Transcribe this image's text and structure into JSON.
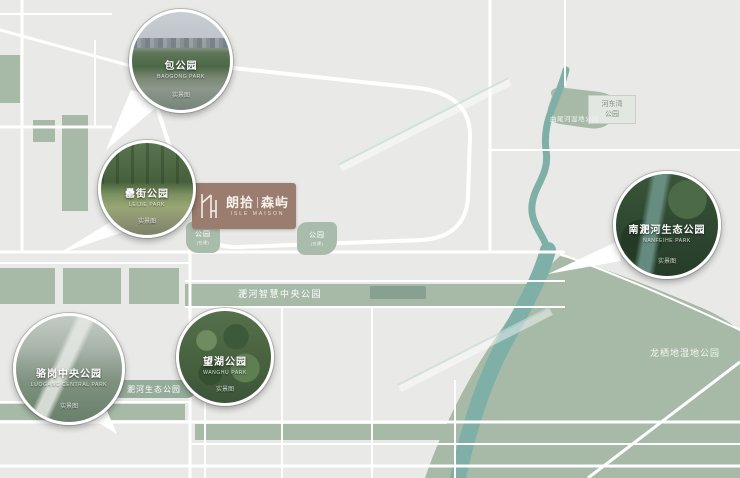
{
  "brand": {
    "cn_left": "朗拾",
    "cn_right": "森屿",
    "en": "ISLE MAISON"
  },
  "circles": {
    "bao": {
      "name": "包公园",
      "pinyin": "BAOGONG PARK",
      "tag": "实景图"
    },
    "lei": {
      "name": "罍街公园",
      "pinyin": "LEIJIE PARK",
      "tag": "实景图"
    },
    "wanghu": {
      "name": "望湖公园",
      "pinyin": "WANGHU PARK",
      "tag": "实景图"
    },
    "luogang": {
      "name": "骆岗中央公园",
      "pinyin": "LUOGANG CENTRAL PARK",
      "tag": "实景图"
    },
    "nanfei": {
      "name": "南淝河生态公园",
      "pinyin": "NANFEIHE PARK",
      "tag": "实景图"
    }
  },
  "labels": {
    "feihe_smart": "淝河智慧中央公园",
    "feihe_eco": "淝河生态公园",
    "longqidi": "龙栖地湿地公园",
    "hedongwan_line1": "河东湾",
    "hedongwan_line2": "公园",
    "quweihe": "曲尾河湿地公园",
    "park_small_left": "公园",
    "park_small_left_sub": "(在建)",
    "park_small_right": "公园",
    "park_small_right_sub": "(在建)"
  },
  "colors": {
    "park_green": "#a7baa8",
    "river_teal": "#7fb0a8",
    "road_white": "#ffffff",
    "brand_brown": "#9b7d6f",
    "background": "#e9eae7"
  }
}
